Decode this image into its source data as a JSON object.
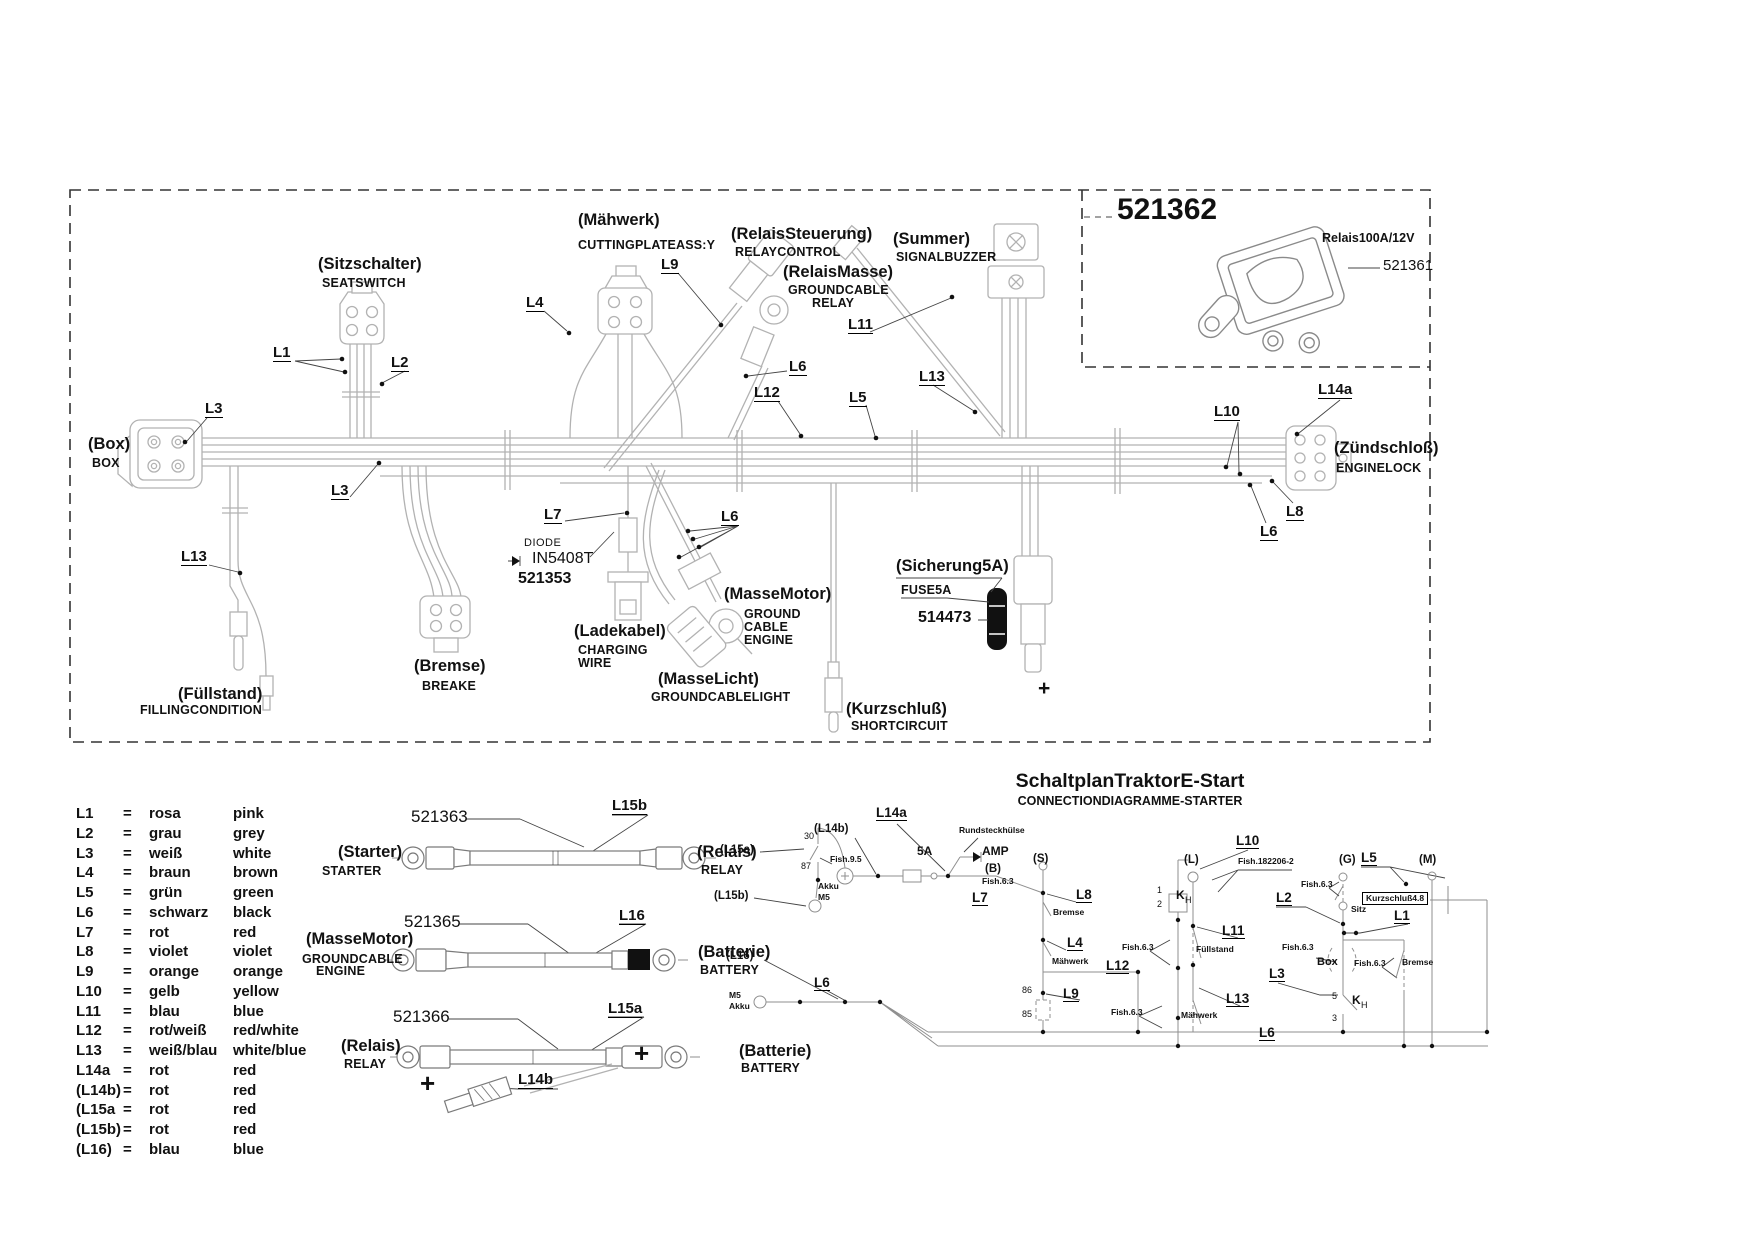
{
  "colors": {
    "background": "#ffffff",
    "harness_gray": "#b2b2b2",
    "text": "#111111",
    "schematic_gray": "#8f8f8f"
  },
  "relay_box": {
    "part_main": "521362",
    "relay_name": "Relais100A/12V",
    "part_relay": "521361"
  },
  "harness": {
    "labels": [
      {
        "t": "(Sitzschalter)",
        "x": 318,
        "y": 256,
        "c": "de"
      },
      {
        "t": "SEATSWITCH",
        "x": 322,
        "y": 277,
        "c": "en"
      },
      {
        "t": "(Mähwerk)",
        "x": 578,
        "y": 212,
        "c": "de"
      },
      {
        "t": "CUTTINGPLATEASS:Y",
        "x": 578,
        "y": 239,
        "c": "en"
      },
      {
        "t": "(RelaisSteuerung)",
        "x": 731,
        "y": 226,
        "c": "de"
      },
      {
        "t": "RELAYCONTROL",
        "x": 735,
        "y": 246,
        "c": "en"
      },
      {
        "t": "(RelaisMasse)",
        "x": 783,
        "y": 264,
        "c": "de"
      },
      {
        "t": "GROUNDCABLE",
        "x": 788,
        "y": 284,
        "c": "en"
      },
      {
        "t": "RELAY",
        "x": 812,
        "y": 297,
        "c": "en"
      },
      {
        "t": "(Summer)",
        "x": 893,
        "y": 231,
        "c": "de"
      },
      {
        "t": "SIGNALBUZZER",
        "x": 896,
        "y": 251,
        "c": "en"
      },
      {
        "t": "(Box)",
        "x": 88,
        "y": 436,
        "c": "de"
      },
      {
        "t": "BOX",
        "x": 92,
        "y": 457,
        "c": "en"
      },
      {
        "t": "(Zündschloß)",
        "x": 1334,
        "y": 440,
        "c": "de"
      },
      {
        "t": "ENGINELOCK",
        "x": 1336,
        "y": 462,
        "c": "en"
      },
      {
        "t": "(Füllstand)",
        "x": 178,
        "y": 686,
        "c": "de"
      },
      {
        "t": "FILLINGCONDITION",
        "x": 140,
        "y": 704,
        "c": "en"
      },
      {
        "t": "(Bremse)",
        "x": 414,
        "y": 658,
        "c": "de"
      },
      {
        "t": "BREAKE",
        "x": 422,
        "y": 680,
        "c": "en"
      },
      {
        "t": "(Ladekabel)",
        "x": 574,
        "y": 623,
        "c": "de"
      },
      {
        "t": "CHARGING",
        "x": 578,
        "y": 644,
        "c": "en"
      },
      {
        "t": "WIRE",
        "x": 578,
        "y": 657,
        "c": "en"
      },
      {
        "t": "(MasseMotor)",
        "x": 724,
        "y": 586,
        "c": "de"
      },
      {
        "t": "GROUND",
        "x": 744,
        "y": 608,
        "c": "en"
      },
      {
        "t": "CABLE",
        "x": 744,
        "y": 621,
        "c": "en"
      },
      {
        "t": "ENGINE",
        "x": 744,
        "y": 634,
        "c": "en"
      },
      {
        "t": "(MasseLicht)",
        "x": 658,
        "y": 671,
        "c": "de"
      },
      {
        "t": "GROUNDCABLELIGHT",
        "x": 651,
        "y": 691,
        "c": "en"
      },
      {
        "t": "(Kurzschluß)",
        "x": 846,
        "y": 701,
        "c": "de"
      },
      {
        "t": "SHORTCIRCUIT",
        "x": 851,
        "y": 720,
        "c": "en"
      },
      {
        "t": "(Sicherung5A)",
        "x": 896,
        "y": 558,
        "c": "de"
      },
      {
        "t": "FUSE5A",
        "x": 901,
        "y": 584,
        "c": "en"
      },
      {
        "t": "514473",
        "x": 918,
        "y": 610,
        "c": "pb"
      },
      {
        "t": "DIODE",
        "x": 524,
        "y": 538,
        "c": "din"
      },
      {
        "t": "IN5408T",
        "x": 532,
        "y": 551,
        "c": "din2"
      },
      {
        "t": "521353",
        "x": 518,
        "y": 571,
        "c": "pb"
      },
      {
        "t": "+",
        "x": 1038,
        "y": 678,
        "c": "plusm",
        "n": "plus-fuse-terminal"
      },
      {
        "t": "L1",
        "x": 273,
        "y": 345,
        "c": "code"
      },
      {
        "t": "L2",
        "x": 391,
        "y": 355,
        "c": "code"
      },
      {
        "t": "L3",
        "x": 205,
        "y": 401,
        "c": "code"
      },
      {
        "t": "L3",
        "x": 331,
        "y": 483,
        "c": "code"
      },
      {
        "t": "L13",
        "x": 181,
        "y": 549,
        "c": "code"
      },
      {
        "t": "L4",
        "x": 526,
        "y": 295,
        "c": "code"
      },
      {
        "t": "L9",
        "x": 661,
        "y": 257,
        "c": "code"
      },
      {
        "t": "L6",
        "x": 789,
        "y": 359,
        "c": "code"
      },
      {
        "t": "L12",
        "x": 754,
        "y": 385,
        "c": "code"
      },
      {
        "t": "L5",
        "x": 849,
        "y": 390,
        "c": "code"
      },
      {
        "t": "L11",
        "x": 848,
        "y": 317,
        "c": "code"
      },
      {
        "t": "L13",
        "x": 919,
        "y": 369,
        "c": "code"
      },
      {
        "t": "L7",
        "x": 544,
        "y": 507,
        "c": "code"
      },
      {
        "t": "L6",
        "x": 721,
        "y": 509,
        "c": "code"
      },
      {
        "t": "L10",
        "x": 1214,
        "y": 404,
        "c": "code"
      },
      {
        "t": "L14a",
        "x": 1318,
        "y": 382,
        "c": "code"
      },
      {
        "t": "L8",
        "x": 1286,
        "y": 504,
        "c": "code"
      },
      {
        "t": "L6",
        "x": 1260,
        "y": 524,
        "c": "code"
      }
    ]
  },
  "cables": {
    "labels": [
      {
        "t": "521363",
        "x": 411,
        "y": 808,
        "c": "part"
      },
      {
        "t": "L15b",
        "x": 612,
        "y": 798,
        "c": "code"
      },
      {
        "t": "(Starter)",
        "x": 338,
        "y": 844,
        "c": "de"
      },
      {
        "t": "STARTER",
        "x": 322,
        "y": 865,
        "c": "en"
      },
      {
        "t": "(Relais)",
        "x": 697,
        "y": 844,
        "c": "de"
      },
      {
        "t": "RELAY",
        "x": 701,
        "y": 864,
        "c": "en"
      },
      {
        "t": "521365",
        "x": 404,
        "y": 913,
        "c": "part"
      },
      {
        "t": "L16",
        "x": 619,
        "y": 908,
        "c": "code"
      },
      {
        "t": "(MasseMotor)",
        "x": 306,
        "y": 931,
        "c": "de"
      },
      {
        "t": "GROUNDCABLE",
        "x": 302,
        "y": 953,
        "c": "en"
      },
      {
        "t": "ENGINE",
        "x": 316,
        "y": 965,
        "c": "en"
      },
      {
        "t": "(Batterie)",
        "x": 698,
        "y": 944,
        "c": "de"
      },
      {
        "t": "BATTERY",
        "x": 700,
        "y": 964,
        "c": "en"
      },
      {
        "t": "521366",
        "x": 393,
        "y": 1008,
        "c": "part"
      },
      {
        "t": "L15a",
        "x": 608,
        "y": 1001,
        "c": "code"
      },
      {
        "t": "(Relais)",
        "x": 341,
        "y": 1038,
        "c": "de"
      },
      {
        "t": "RELAY",
        "x": 344,
        "y": 1058,
        "c": "en"
      },
      {
        "t": "(Batterie)",
        "x": 739,
        "y": 1043,
        "c": "de"
      },
      {
        "t": "BATTERY",
        "x": 741,
        "y": 1062,
        "c": "en"
      },
      {
        "t": "+",
        "x": 634,
        "y": 1040,
        "c": "plus",
        "n": "plus-battery-cable"
      },
      {
        "t": "+",
        "x": 420,
        "y": 1070,
        "c": "plus",
        "n": "plus-branch-terminal"
      },
      {
        "t": "L14b",
        "x": 518,
        "y": 1072,
        "c": "code"
      }
    ]
  },
  "legend": {
    "rows": [
      {
        "c": "L1",
        "e": "=",
        "d": "rosa",
        "en": "pink"
      },
      {
        "c": "L2",
        "e": "=",
        "d": "grau",
        "en": "grey"
      },
      {
        "c": "L3",
        "e": "=",
        "d": "weiß",
        "en": "white"
      },
      {
        "c": "L4",
        "e": "=",
        "d": "braun",
        "en": "brown"
      },
      {
        "c": "L5",
        "e": "=",
        "d": "grün",
        "en": "green"
      },
      {
        "c": "L6",
        "e": "=",
        "d": "schwarz",
        "en": "black"
      },
      {
        "c": "L7",
        "e": "=",
        "d": "rot",
        "en": "red"
      },
      {
        "c": "L8",
        "e": "=",
        "d": "violet",
        "en": "violet"
      },
      {
        "c": "L9",
        "e": "=",
        "d": "orange",
        "en": "orange"
      },
      {
        "c": "L10",
        "e": "=",
        "d": "gelb",
        "en": "yellow"
      },
      {
        "c": "L11",
        "e": "=",
        "d": "blau",
        "en": "blue"
      },
      {
        "c": "L12",
        "e": "=",
        "d": "rot/weiß",
        "en": "red/white"
      },
      {
        "c": "L13",
        "e": "=",
        "d": "weiß/blau",
        "en": "white/blue"
      },
      {
        "c": "L14a",
        "e": "=",
        "d": "rot",
        "en": "red"
      },
      {
        "c": "(L14b)",
        "e": "=",
        "d": "rot",
        "en": "red"
      },
      {
        "c": "(L15a",
        "e": "=",
        "d": "rot",
        "en": "red"
      },
      {
        "c": "(L15b)",
        "e": "=",
        "d": "rot",
        "en": "red"
      },
      {
        "c": "(L16)",
        "e": "=",
        "d": "blau",
        "en": "blue"
      }
    ]
  },
  "schematic": {
    "title": "SchaltplanTraktorE-Start",
    "subtitle": "CONNECTIONDIAGRAMME-STARTER",
    "labels": [
      {
        "t": "L14a",
        "x": 876,
        "y": 806,
        "c": "sl"
      },
      {
        "t": "(L14b)",
        "x": 814,
        "y": 824,
        "c": "sp"
      },
      {
        "t": "Rundsteckhülse",
        "x": 959,
        "y": 826,
        "c": "ss"
      },
      {
        "t": "5A",
        "x": 917,
        "y": 845,
        "c": "sl2"
      },
      {
        "t": "AMP",
        "x": 982,
        "y": 845,
        "c": "sl2"
      },
      {
        "t": "(S)",
        "x": 1033,
        "y": 854,
        "c": "sp"
      },
      {
        "t": "(B)",
        "x": 985,
        "y": 864,
        "c": "sp"
      },
      {
        "t": "Fish.6.3",
        "x": 982,
        "y": 877,
        "c": "ss"
      },
      {
        "t": "L7",
        "x": 972,
        "y": 891,
        "c": "sl"
      },
      {
        "t": "Akku",
        "x": 818,
        "y": 882,
        "c": "ss"
      },
      {
        "t": "M5",
        "x": 818,
        "y": 893,
        "c": "ss"
      },
      {
        "t": "(L15a)",
        "x": 720,
        "y": 845,
        "c": "sp"
      },
      {
        "t": "30",
        "x": 804,
        "y": 832,
        "c": "st"
      },
      {
        "t": "87",
        "x": 801,
        "y": 862,
        "c": "st"
      },
      {
        "t": "Fish.9.5",
        "x": 830,
        "y": 855,
        "c": "ss"
      },
      {
        "t": "(L15b)",
        "x": 714,
        "y": 891,
        "c": "sp"
      },
      {
        "t": "(L16)",
        "x": 726,
        "y": 951,
        "c": "sp"
      },
      {
        "t": "M5",
        "x": 729,
        "y": 991,
        "c": "ss"
      },
      {
        "t": "Akku",
        "x": 729,
        "y": 1002,
        "c": "ss"
      },
      {
        "t": "L6",
        "x": 814,
        "y": 976,
        "c": "sl"
      },
      {
        "t": "L8",
        "x": 1076,
        "y": 888,
        "c": "sl"
      },
      {
        "t": "Bremse",
        "x": 1053,
        "y": 908,
        "c": "ss"
      },
      {
        "t": "L4",
        "x": 1067,
        "y": 936,
        "c": "sl"
      },
      {
        "t": "Mähwerk",
        "x": 1052,
        "y": 957,
        "c": "ss"
      },
      {
        "t": "L12",
        "x": 1106,
        "y": 959,
        "c": "sl"
      },
      {
        "t": "L9",
        "x": 1063,
        "y": 987,
        "c": "sl"
      },
      {
        "t": "86",
        "x": 1022,
        "y": 986,
        "c": "st"
      },
      {
        "t": "85",
        "x": 1022,
        "y": 1010,
        "c": "st"
      },
      {
        "t": "Fish.6.3",
        "x": 1122,
        "y": 943,
        "c": "ss"
      },
      {
        "t": "Fish.6.3",
        "x": 1111,
        "y": 1008,
        "c": "ss"
      },
      {
        "t": "Mähwerk",
        "x": 1181,
        "y": 1011,
        "c": "ss"
      },
      {
        "t": "L10",
        "x": 1236,
        "y": 834,
        "c": "sl"
      },
      {
        "t": "(L)",
        "x": 1184,
        "y": 855,
        "c": "sp"
      },
      {
        "t": "Fish.182206-2",
        "x": 1238,
        "y": 857,
        "c": "ss"
      },
      {
        "t": "1",
        "x": 1157,
        "y": 886,
        "c": "st"
      },
      {
        "t": "2",
        "x": 1157,
        "y": 900,
        "c": "st"
      },
      {
        "t": "K",
        "x": 1176,
        "y": 889,
        "c": "sl2"
      },
      {
        "t": "H",
        "x": 1185,
        "y": 896,
        "c": "st"
      },
      {
        "t": "L11",
        "x": 1222,
        "y": 924,
        "c": "sl"
      },
      {
        "t": "Füllstand",
        "x": 1196,
        "y": 945,
        "c": "ss"
      },
      {
        "t": "L13",
        "x": 1226,
        "y": 992,
        "c": "sl"
      },
      {
        "t": "L6",
        "x": 1259,
        "y": 1026,
        "c": "sl"
      },
      {
        "t": "(G)",
        "x": 1339,
        "y": 855,
        "c": "sp"
      },
      {
        "t": "L5",
        "x": 1361,
        "y": 851,
        "c": "sl"
      },
      {
        "t": "(M)",
        "x": 1419,
        "y": 855,
        "c": "sp"
      },
      {
        "t": "Fish.6.3",
        "x": 1301,
        "y": 880,
        "c": "ss"
      },
      {
        "t": "Kurzschluß4.8",
        "x": 1362,
        "y": 892,
        "c": "ssbox"
      },
      {
        "t": "Sitz",
        "x": 1351,
        "y": 905,
        "c": "ss"
      },
      {
        "t": "L2",
        "x": 1276,
        "y": 891,
        "c": "sl"
      },
      {
        "t": "L1",
        "x": 1394,
        "y": 909,
        "c": "sl"
      },
      {
        "t": "Fish.6.3",
        "x": 1282,
        "y": 943,
        "c": "ss"
      },
      {
        "t": "Box",
        "x": 1317,
        "y": 957,
        "c": "ss2"
      },
      {
        "t": "Fish.6.3",
        "x": 1354,
        "y": 959,
        "c": "ss"
      },
      {
        "t": "Bremse",
        "x": 1402,
        "y": 958,
        "c": "ss"
      },
      {
        "t": "L3",
        "x": 1269,
        "y": 967,
        "c": "sl"
      },
      {
        "t": "5",
        "x": 1332,
        "y": 992,
        "c": "st"
      },
      {
        "t": "K",
        "x": 1352,
        "y": 994,
        "c": "sl2"
      },
      {
        "t": "H",
        "x": 1361,
        "y": 1001,
        "c": "st"
      },
      {
        "t": "3",
        "x": 1332,
        "y": 1014,
        "c": "st"
      }
    ]
  }
}
